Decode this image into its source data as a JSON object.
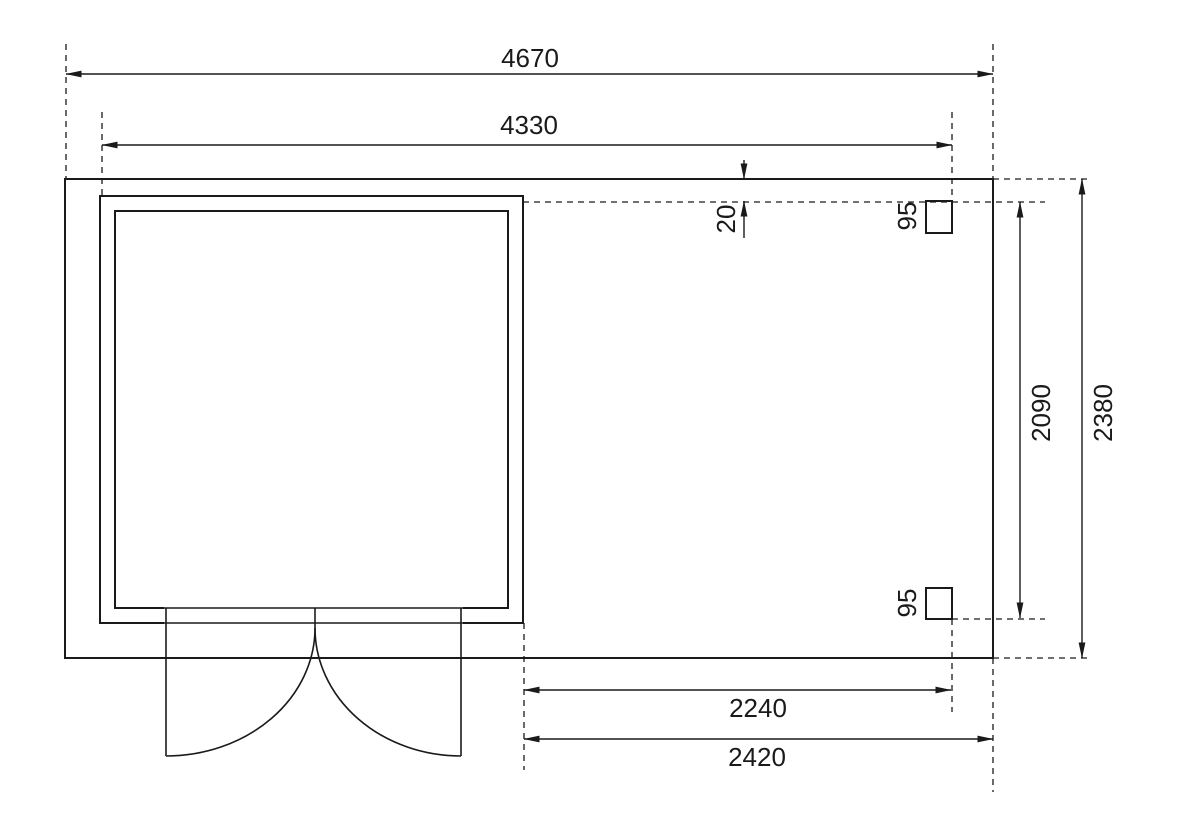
{
  "drawing": {
    "type": "floor-plan",
    "dimensions": {
      "overall_width": {
        "label": "4670"
      },
      "shed_outer_width": {
        "label": "4330"
      },
      "front_offset": {
        "label": "20"
      },
      "post_top": {
        "label": "95"
      },
      "post_bottom": {
        "label": "95"
      },
      "post_span_depth": {
        "label": "2090"
      },
      "overall_depth": {
        "label": "2380"
      },
      "canopy_post_width": {
        "label": "2240"
      },
      "canopy_width": {
        "label": "2420"
      }
    },
    "colors": {
      "background": "#ffffff",
      "floor_fill": "#f3f3f3",
      "wall_fill": "#b0b0b0",
      "interior_fill": "#fafafa",
      "opening_fill": "#ffffff",
      "post_fill": "#ababab",
      "line": "#1a1a1a"
    }
  }
}
